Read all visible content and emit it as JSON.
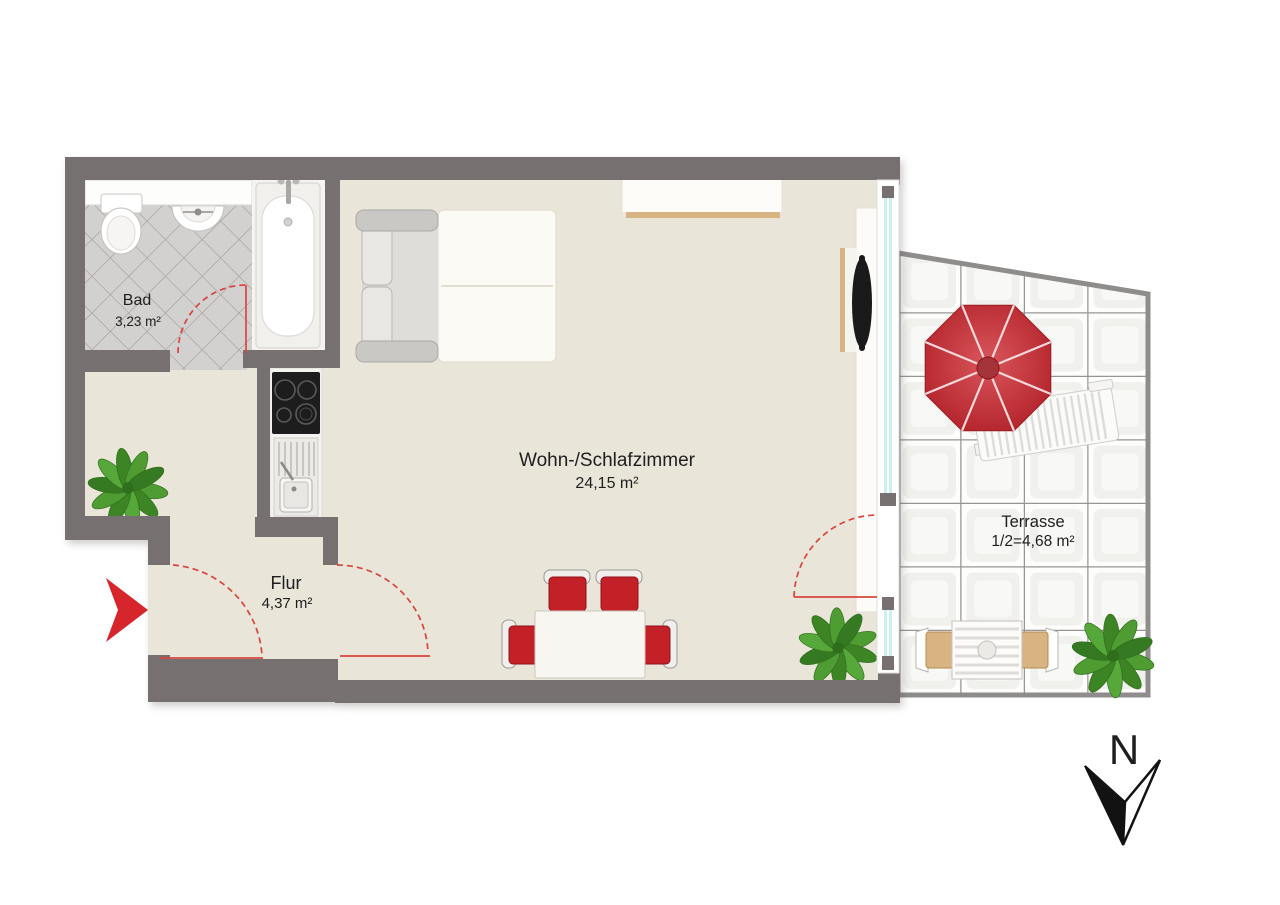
{
  "rooms": [
    {
      "id": "bad",
      "name": "Bad",
      "area": "3,23 m²"
    },
    {
      "id": "flur",
      "name": "Flur",
      "area": "4,37 m²"
    },
    {
      "id": "wohnzimmer",
      "name": "Wohn-/Schlafzimmer",
      "area": "24,15 m²"
    },
    {
      "id": "terrasse",
      "name": "Terrasse",
      "area": "1/2=4,68 m²"
    }
  ],
  "compass": {
    "label": "N"
  },
  "colors": {
    "wall": "#767071",
    "floor": "#e9e5d9",
    "bath_tile_bg": "#d2d1d0",
    "bath_tile_line": "#a3a09e",
    "terrace_tile_bg": "#fdfdfc",
    "terrace_tile_inner": "#f0f0ed",
    "terrace_grid_line": "#979593",
    "terrace_border": "#8f8d8c",
    "door_red": "#d8453f",
    "arrow_red": "#d6252b",
    "chair_red": "#c32127",
    "umbrella_dark": "#b01f26",
    "umbrella_light": "#d9565c",
    "plant_green": "#4f9c33",
    "plant_green_dark": "#3c8424",
    "window_glass": "#cdeeee",
    "wood": "#d9b483",
    "furniture_white": "#fbfaf4"
  }
}
